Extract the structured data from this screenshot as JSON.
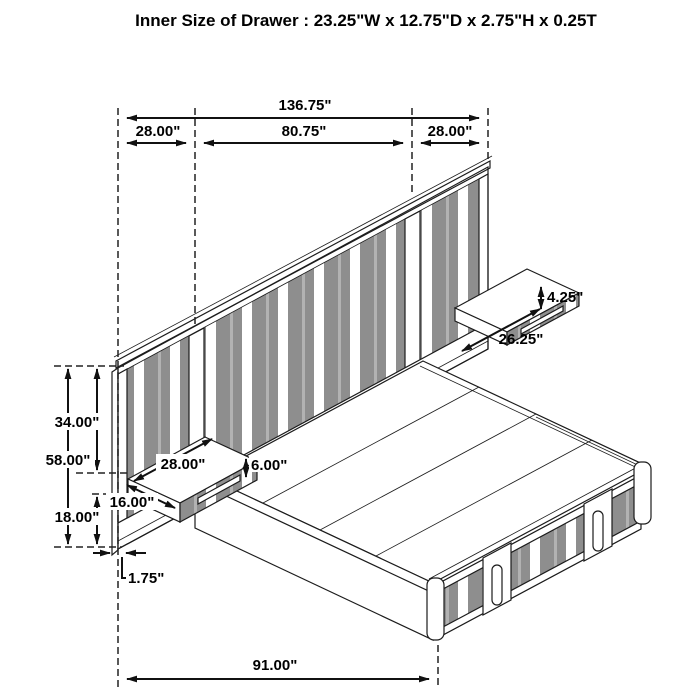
{
  "title": "Inner Size of Drawer : 23.25\"W x 12.75\"D x 2.75\"H x 0.25T",
  "dims": {
    "total_width": "136.75\"",
    "left_wing_width": "28.00\"",
    "center_width": "80.75\"",
    "right_wing_width": "28.00\"",
    "right_shelf_height": "4.25\"",
    "right_shelf_width": "26.25\"",
    "top_to_shelf": "34.00\"",
    "headboard_height": "58.00\"",
    "left_shelf_width": "28.00\"",
    "left_shelf_height": "6.00\"",
    "left_shelf_depth": "16.00\"",
    "shelf_to_floor": "18.00\"",
    "panel_thickness": "1.75\"",
    "bed_length": "91.00\""
  },
  "colors": {
    "line": "#1c1c1c",
    "stripe_dark": "#8e8e8e",
    "stripe_light": "#b2b2b2",
    "background": "#ffffff"
  }
}
